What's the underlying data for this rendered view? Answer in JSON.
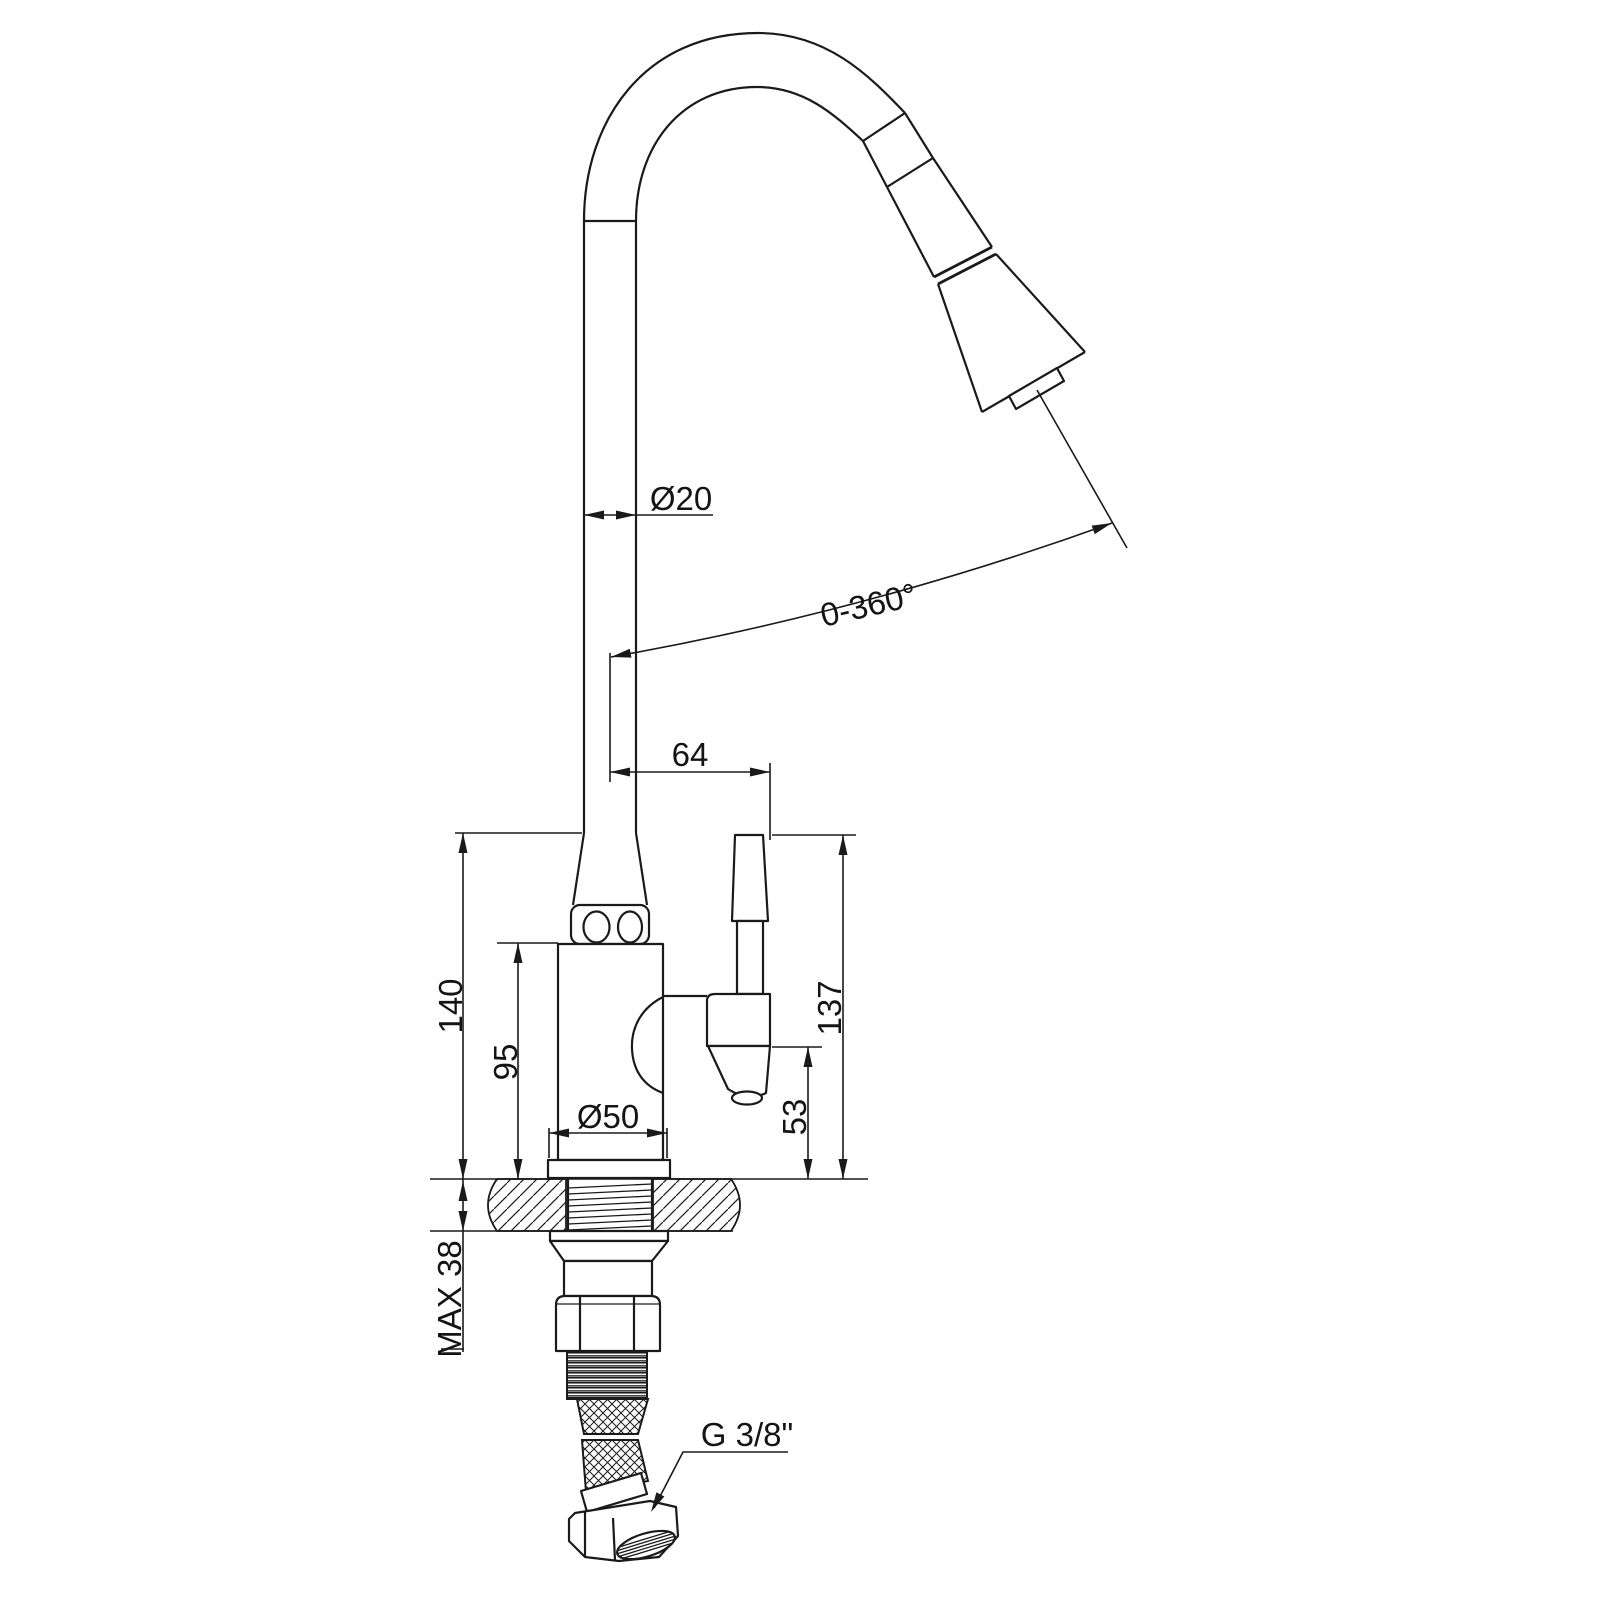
{
  "canvas": {
    "background": "#ffffff",
    "line_color": "#1a1a1a"
  },
  "dimensions": {
    "spout_diameter": "Ø20",
    "swivel_range": "0-360°",
    "spout_to_handle_offset": "64",
    "column_height": "140",
    "body_height": "95",
    "base_diameter": "Ø50",
    "handle_height": "137",
    "handle_bottom_height": "53",
    "max_counter_thickness": "MAX 38",
    "supply_thread": "G 3/8\""
  }
}
